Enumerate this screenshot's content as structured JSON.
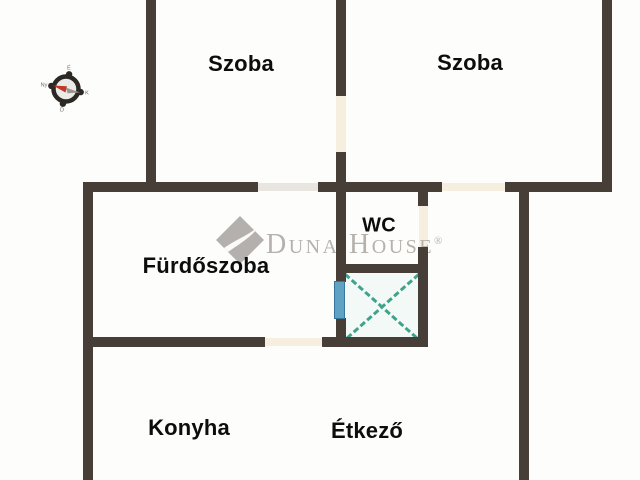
{
  "canvas": {
    "width": 640,
    "height": 480,
    "background": "#fdfdfb"
  },
  "palette": {
    "wall": "#473e37",
    "door": "#f6efdf",
    "door_gray": "#e9e6e1",
    "window_fill": "#5ea3c4",
    "window_stroke": "#38769b",
    "shaft_fill": "#f3f9f6",
    "shaft_line": "#3fa38c",
    "label_color": "#0d0d0d",
    "watermark_color": "#b5b1ad",
    "compass_ring": "#2c2824",
    "compass_needle_red": "#c0392b",
    "compass_needle_gray": "#9a968f"
  },
  "rooms": [
    {
      "id": "szoba-1",
      "label": "Szoba",
      "cx": 241,
      "cy": 64,
      "size": 22
    },
    {
      "id": "szoba-2",
      "label": "Szoba",
      "cx": 470,
      "cy": 63,
      "size": 22
    },
    {
      "id": "wc",
      "label": "WC",
      "cx": 379,
      "cy": 226,
      "size": 20
    },
    {
      "id": "furdoszoba",
      "label": "Fürdőszoba",
      "cx": 206,
      "cy": 266,
      "size": 22
    },
    {
      "id": "konyha",
      "label": "Konyha",
      "cx": 189,
      "cy": 428,
      "size": 22
    },
    {
      "id": "etkezo",
      "label": "Étkező",
      "cx": 367,
      "cy": 431,
      "size": 22
    }
  ],
  "walls": [
    {
      "x": 146,
      "y": 0,
      "w": 10,
      "h": 192
    },
    {
      "x": 336,
      "y": 0,
      "w": 10,
      "h": 96
    },
    {
      "x": 336,
      "y": 152,
      "w": 10,
      "h": 40
    },
    {
      "x": 602,
      "y": 0,
      "w": 10,
      "h": 192
    },
    {
      "x": 83,
      "y": 182,
      "w": 10,
      "h": 298
    },
    {
      "x": 336,
      "y": 182,
      "w": 10,
      "h": 100
    },
    {
      "x": 336,
      "y": 318,
      "w": 10,
      "h": 29
    },
    {
      "x": 418,
      "y": 192,
      "w": 10,
      "h": 14
    },
    {
      "x": 418,
      "y": 247,
      "w": 10,
      "h": 100
    },
    {
      "x": 519,
      "y": 182,
      "w": 10,
      "h": 298
    },
    {
      "x": 83,
      "y": 182,
      "w": 175,
      "h": 10
    },
    {
      "x": 318,
      "y": 182,
      "w": 124,
      "h": 10
    },
    {
      "x": 505,
      "y": 182,
      "w": 107,
      "h": 10
    },
    {
      "x": 83,
      "y": 337,
      "w": 182,
      "h": 10
    },
    {
      "x": 322,
      "y": 337,
      "w": 106,
      "h": 10
    },
    {
      "x": 342,
      "y": 264,
      "w": 86,
      "h": 9
    }
  ],
  "openings": [
    {
      "x": 336,
      "y": 96,
      "w": 10,
      "h": 56,
      "type": "door"
    },
    {
      "x": 258,
      "y": 183,
      "w": 60,
      "h": 8,
      "type": "door_gray"
    },
    {
      "x": 442,
      "y": 183,
      "w": 63,
      "h": 8,
      "type": "door"
    },
    {
      "x": 265,
      "y": 338,
      "w": 57,
      "h": 8,
      "type": "door"
    },
    {
      "x": 419,
      "y": 206,
      "w": 9,
      "h": 41,
      "type": "door"
    }
  ],
  "window": {
    "x": 334,
    "y": 281,
    "w": 11,
    "h": 38
  },
  "shaft": {
    "x": 346,
    "y": 273,
    "w": 72,
    "h": 64
  },
  "compass": {
    "cx": 66,
    "cy": 89,
    "labels": {
      "n": "É",
      "e": "K",
      "s": "D",
      "w": "Ny"
    }
  },
  "watermark": {
    "brand": "Duna House",
    "registered": "®"
  }
}
